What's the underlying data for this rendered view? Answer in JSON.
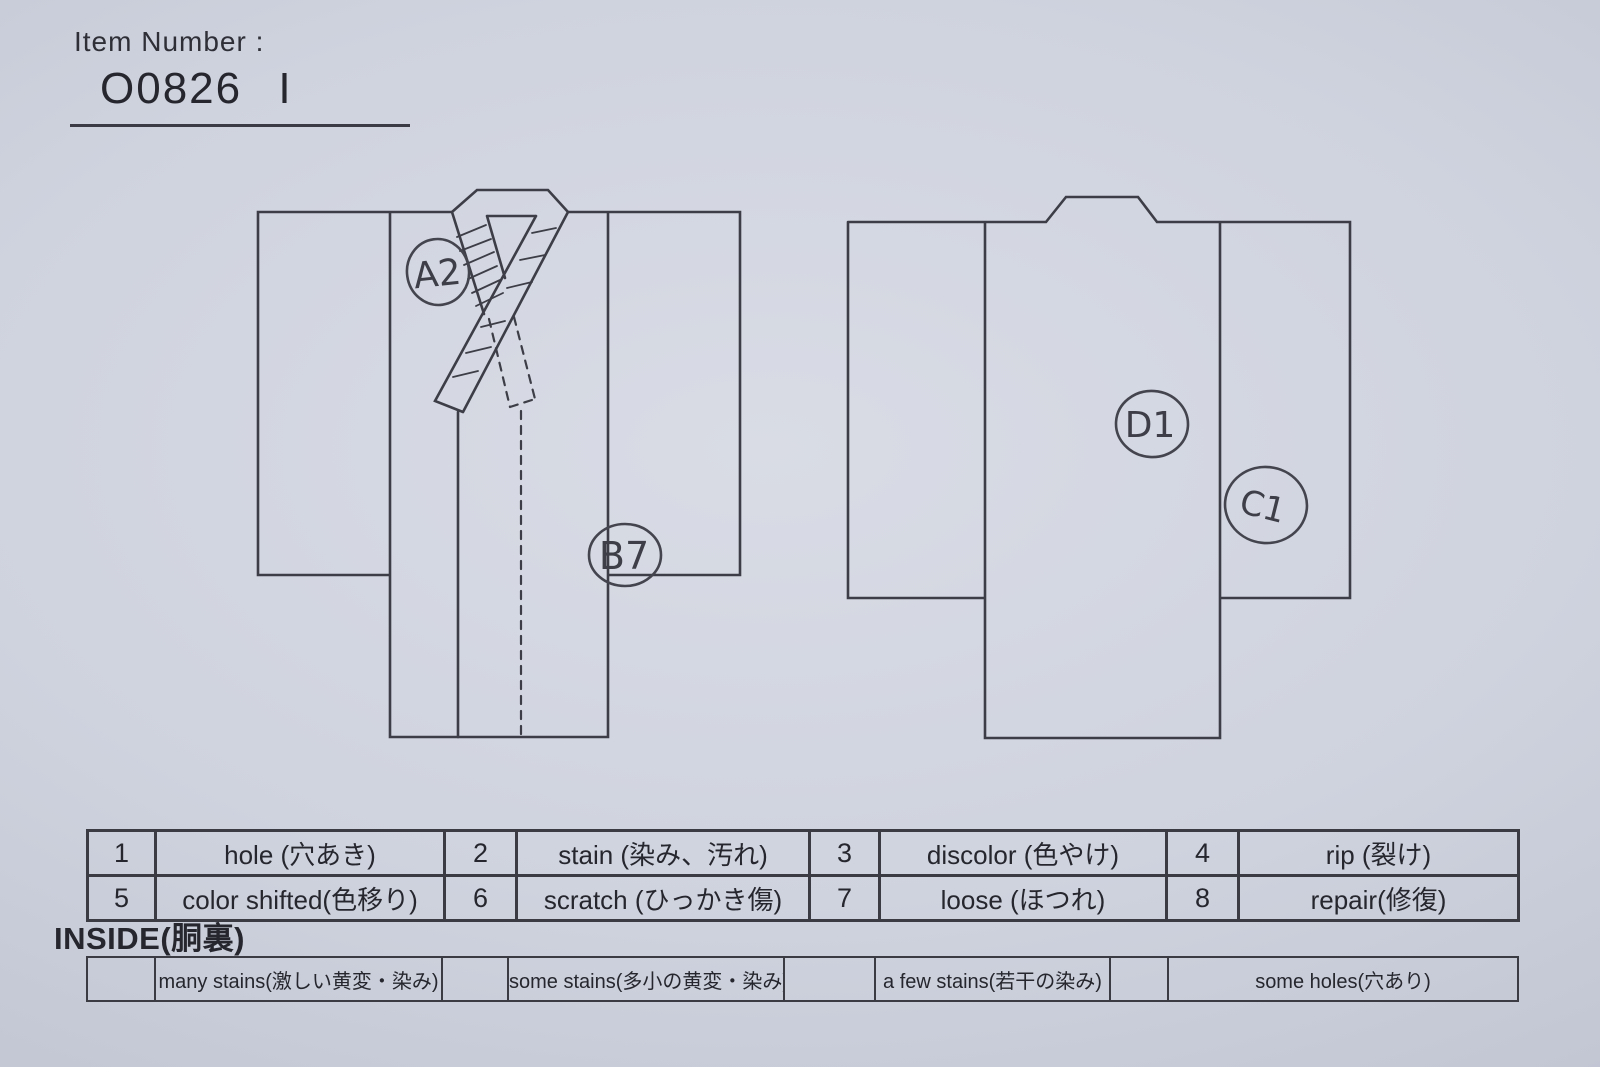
{
  "header": {
    "item_number_label": "Item Number :",
    "item_number_value": "O0826 I"
  },
  "diagram": {
    "front_marks": [
      {
        "id": "A2"
      },
      {
        "id": "B7"
      }
    ],
    "back_marks": [
      {
        "id": "D1"
      },
      {
        "id": "C1"
      }
    ]
  },
  "defect_legend": {
    "rows": [
      [
        {
          "num": "1",
          "label": "hole (穴あき)"
        },
        {
          "num": "2",
          "label": "stain (染み、汚れ)"
        },
        {
          "num": "3",
          "label": "discolor (色やけ)"
        },
        {
          "num": "4",
          "label": "rip (裂け)"
        }
      ],
      [
        {
          "num": "5",
          "label": "color shifted(色移り)"
        },
        {
          "num": "6",
          "label": "scratch (ひっかき傷)"
        },
        {
          "num": "7",
          "label": "loose (ほつれ)"
        },
        {
          "num": "8",
          "label": "repair(修復)"
        }
      ]
    ]
  },
  "inside_section": {
    "heading": "INSIDE(胴裏)",
    "options": [
      {
        "label": "many stains(激しい黄変・染み)"
      },
      {
        "label": "some stains(多小の黄変・染み)"
      },
      {
        "label": "a few stains(若干の染み)"
      },
      {
        "label": "some holes(穴あり)"
      }
    ]
  },
  "colors": {
    "paper": "#ccd0dc",
    "ink": "#3a3b43",
    "pen": "#3d3e47"
  }
}
